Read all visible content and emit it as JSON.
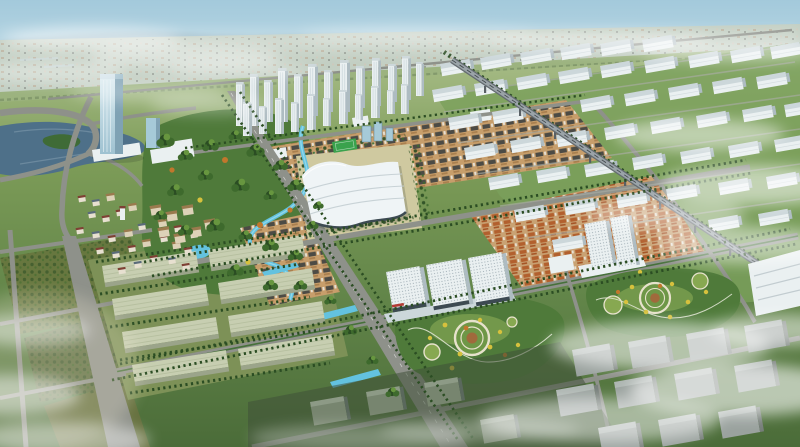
{
  "meta": {
    "alt": "Bird's-eye architectural rendering of a planned city district: central exhibition hall with wavy white roof, high-rise towers, canals, parks, commercial blocks, elevated railway and industrial warehouses under drifting clouds"
  },
  "palette": {
    "sky_top": "#a3c9db",
    "sky_mid": "#bedbe6",
    "horizon_haze": "#dcebee",
    "hills": "#8ba7b6",
    "far_plain": "#c3cfc3",
    "far_green": "#9cb37f",
    "grass_far": "#aabe8a",
    "grass_mid": "#7d9c58",
    "grass": "#628549",
    "grass_dark": "#4b6c39",
    "park_green": "#4f7a3a",
    "tree_dark": "#2b4d23",
    "tree_mid": "#3e6a2d",
    "tree_light": "#67963f",
    "tree_autumn": "#c1772c",
    "tree_yellow": "#d6c13d",
    "lake": "#4e7089",
    "canal": "#63c2df",
    "road": "#8e918a",
    "road_light": "#a9aca4",
    "road_dark": "#61665f",
    "rail": "#646b70",
    "rail_light": "#9aa3a8",
    "bldg_white": "#eaf0f1",
    "bldg_side": "#aebcc2",
    "bldg_roof": "#ccd7da",
    "tan_block": "#c79e6b",
    "roof_dark": "#4c4b45",
    "roof_orange": "#b2602e",
    "glass_blue": "#a6cad8",
    "glass_deep": "#5d8296",
    "plaza": "#cfc9a0",
    "hall_white": "#eff4f6",
    "hall_shade": "#c3ced3",
    "glass_front": "#3d4a52",
    "warehouse": "#c7ceb1",
    "warehouse_side": "#9ba48a",
    "massing": "#9aa29e",
    "massing_side": "#767e79",
    "field": "#3aa24d",
    "accent_red": "#b23b35",
    "mist": "#ffffff"
  }
}
